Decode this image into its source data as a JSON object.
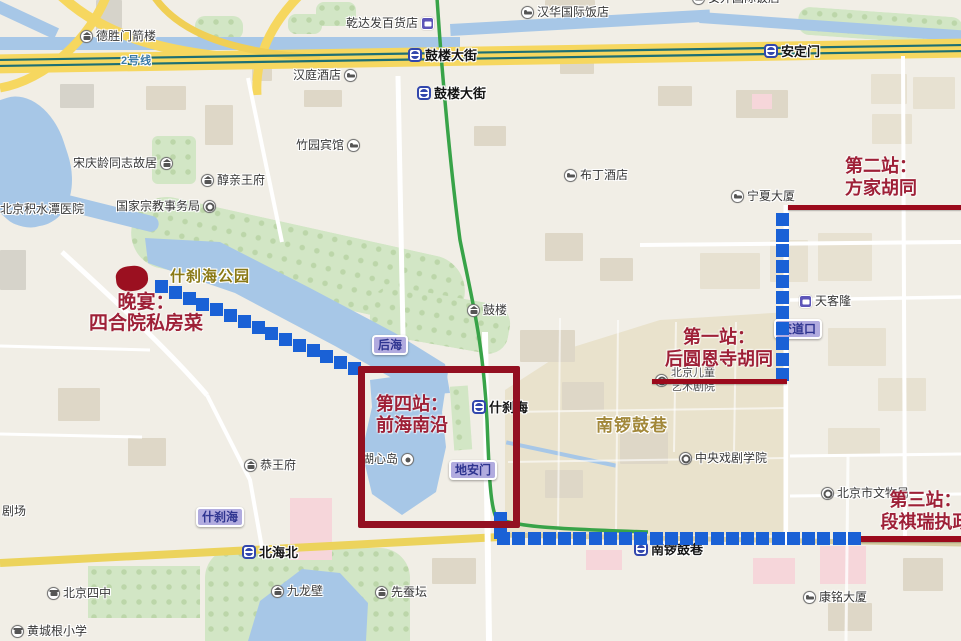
{
  "colors": {
    "route_dot": "#1a61d6",
    "annotation_text": "#9e2037",
    "annotation_line": "#9b0a1c",
    "subway_line2": "#1e6f73",
    "subway_line8": "#38a348",
    "water": "#a7c7e7",
    "park": "#d2e6c5",
    "hutong_area": "#e9e2cc",
    "major_road": "#f6d75f"
  },
  "annotations": {
    "stop1": {
      "line1": "第一站：",
      "line2": "后圆恩寺胡同"
    },
    "stop2": {
      "line1": "第二站：",
      "line2": "方家胡同"
    },
    "stop3": {
      "line1": "第三站：",
      "line2": "段祺瑞执政"
    },
    "stop4": {
      "line1": "第四站：",
      "line2": "前海南沿"
    },
    "dinner": {
      "line1": "晚宴：",
      "line2": "四合院私房菜"
    }
  },
  "stations": [
    {
      "label": "鼓楼大街",
      "x": 408,
      "y": 45
    },
    {
      "label": "鼓楼大街",
      "x": 417,
      "y": 83
    },
    {
      "label": "安定门",
      "x": 764,
      "y": 41
    },
    {
      "label": "什刹海",
      "x": 472,
      "y": 397
    },
    {
      "label": "南锣鼓巷",
      "x": 634,
      "y": 539
    },
    {
      "label": "北海北",
      "x": 242,
      "y": 542
    }
  ],
  "pois": [
    {
      "label": "德胜门箭楼",
      "icon": "temple",
      "side": "right",
      "x": 80,
      "y": 30
    },
    {
      "label": "乾达发百货店",
      "icon": "shop",
      "side": "left",
      "x": 346,
      "y": 17
    },
    {
      "label": "汉华国际饭店",
      "icon": "hotel",
      "side": "right",
      "x": 521,
      "y": 6
    },
    {
      "label": "安外国际饭店",
      "icon": "hotel",
      "side": "right",
      "x": 692,
      "y": -8
    },
    {
      "label": "汉庭酒店",
      "icon": "hotel",
      "side": "left",
      "x": 293,
      "y": 69
    },
    {
      "label": "竹园宾馆",
      "icon": "hotel",
      "side": "left",
      "x": 296,
      "y": 139
    },
    {
      "label": "布丁酒店",
      "icon": "hotel",
      "side": "right",
      "x": 564,
      "y": 169
    },
    {
      "label": "宋庆龄同志故居",
      "icon": "temple",
      "side": "left",
      "x": 73,
      "y": 157
    },
    {
      "label": "醇亲王府",
      "icon": "temple",
      "side": "right",
      "x": 201,
      "y": 174
    },
    {
      "label": "国家宗教事务局",
      "icon": "gov",
      "side": "left",
      "x": 116,
      "y": 200
    },
    {
      "label": "北京积水潭医院",
      "icon": "none",
      "side": "right",
      "x": 0,
      "y": 203
    },
    {
      "label": "宁夏大厦",
      "icon": "hotel",
      "side": "right",
      "x": 731,
      "y": 190
    },
    {
      "label": "天客隆",
      "icon": "shop",
      "side": "right",
      "x": 799,
      "y": 295
    },
    {
      "label": "鼓楼",
      "icon": "temple",
      "side": "right",
      "x": 467,
      "y": 304
    },
    {
      "label": "北京儿童",
      "label2": "艺术剧院",
      "icon": "gov",
      "side": "right",
      "small": true,
      "x": 655,
      "y": 367
    },
    {
      "label": "恭王府",
      "icon": "temple",
      "side": "right",
      "x": 244,
      "y": 459
    },
    {
      "label": "湖心岛",
      "icon": "sight",
      "side": "left",
      "x": 362,
      "y": 453
    },
    {
      "label": "中央戏剧学院",
      "icon": "gov",
      "side": "right",
      "x": 679,
      "y": 452
    },
    {
      "label": "北京市文物局",
      "icon": "gov",
      "side": "right",
      "x": 821,
      "y": 487
    },
    {
      "label": "康铭大厦",
      "icon": "hotel",
      "side": "right",
      "x": 803,
      "y": 591
    },
    {
      "label": "剧场",
      "icon": "none",
      "side": "right",
      "x": 2,
      "y": 505
    },
    {
      "label": "北京四中",
      "icon": "school",
      "side": "right",
      "x": 47,
      "y": 587
    },
    {
      "label": "黄城根小学",
      "icon": "school",
      "side": "right",
      "x": 11,
      "y": 625
    },
    {
      "label": "九龙壁",
      "icon": "temple",
      "side": "right",
      "x": 271,
      "y": 585
    },
    {
      "label": "先蚕坛",
      "icon": "temple",
      "side": "right",
      "x": 375,
      "y": 586
    }
  ],
  "bubbles": [
    {
      "label": "后海",
      "x": 372,
      "y": 335
    },
    {
      "label": "地安门",
      "x": 449,
      "y": 460
    },
    {
      "label": "什刹海",
      "x": 196,
      "y": 507
    },
    {
      "label": "交道口",
      "x": 774,
      "y": 319
    }
  ],
  "area_labels": [
    {
      "label": "什刹海公园",
      "x": 170,
      "y": 265,
      "size": 15,
      "color": "#8a7916"
    },
    {
      "label": "南锣鼓巷",
      "x": 596,
      "y": 411,
      "size": 17,
      "color": "#a2883a"
    },
    {
      "label": "2号线",
      "x": 121,
      "y": 52,
      "size": 11,
      "color": "#3c7ba8"
    }
  ],
  "routes": [
    {
      "from": [
        155,
        280
      ],
      "to": [
        348,
        362
      ],
      "n": 15
    },
    {
      "from": [
        776,
        213
      ],
      "to": [
        776,
        368
      ],
      "n": 11
    },
    {
      "from": [
        494,
        512
      ],
      "to": [
        494,
        526
      ],
      "n": 2
    },
    {
      "from": [
        497,
        532
      ],
      "to": [
        848,
        532
      ],
      "n": 24
    }
  ],
  "red_lines": [
    {
      "x": 788,
      "y": 205,
      "w": 173,
      "h": 5
    },
    {
      "x": 652,
      "y": 379,
      "w": 135,
      "h": 5
    },
    {
      "x": 861,
      "y": 536,
      "w": 100,
      "h": 6
    }
  ],
  "red_box": {
    "x": 358,
    "y": 366,
    "w": 148,
    "h": 148
  },
  "dinner_marker": {
    "x": 116,
    "y": 266,
    "w": 32,
    "h": 25
  }
}
